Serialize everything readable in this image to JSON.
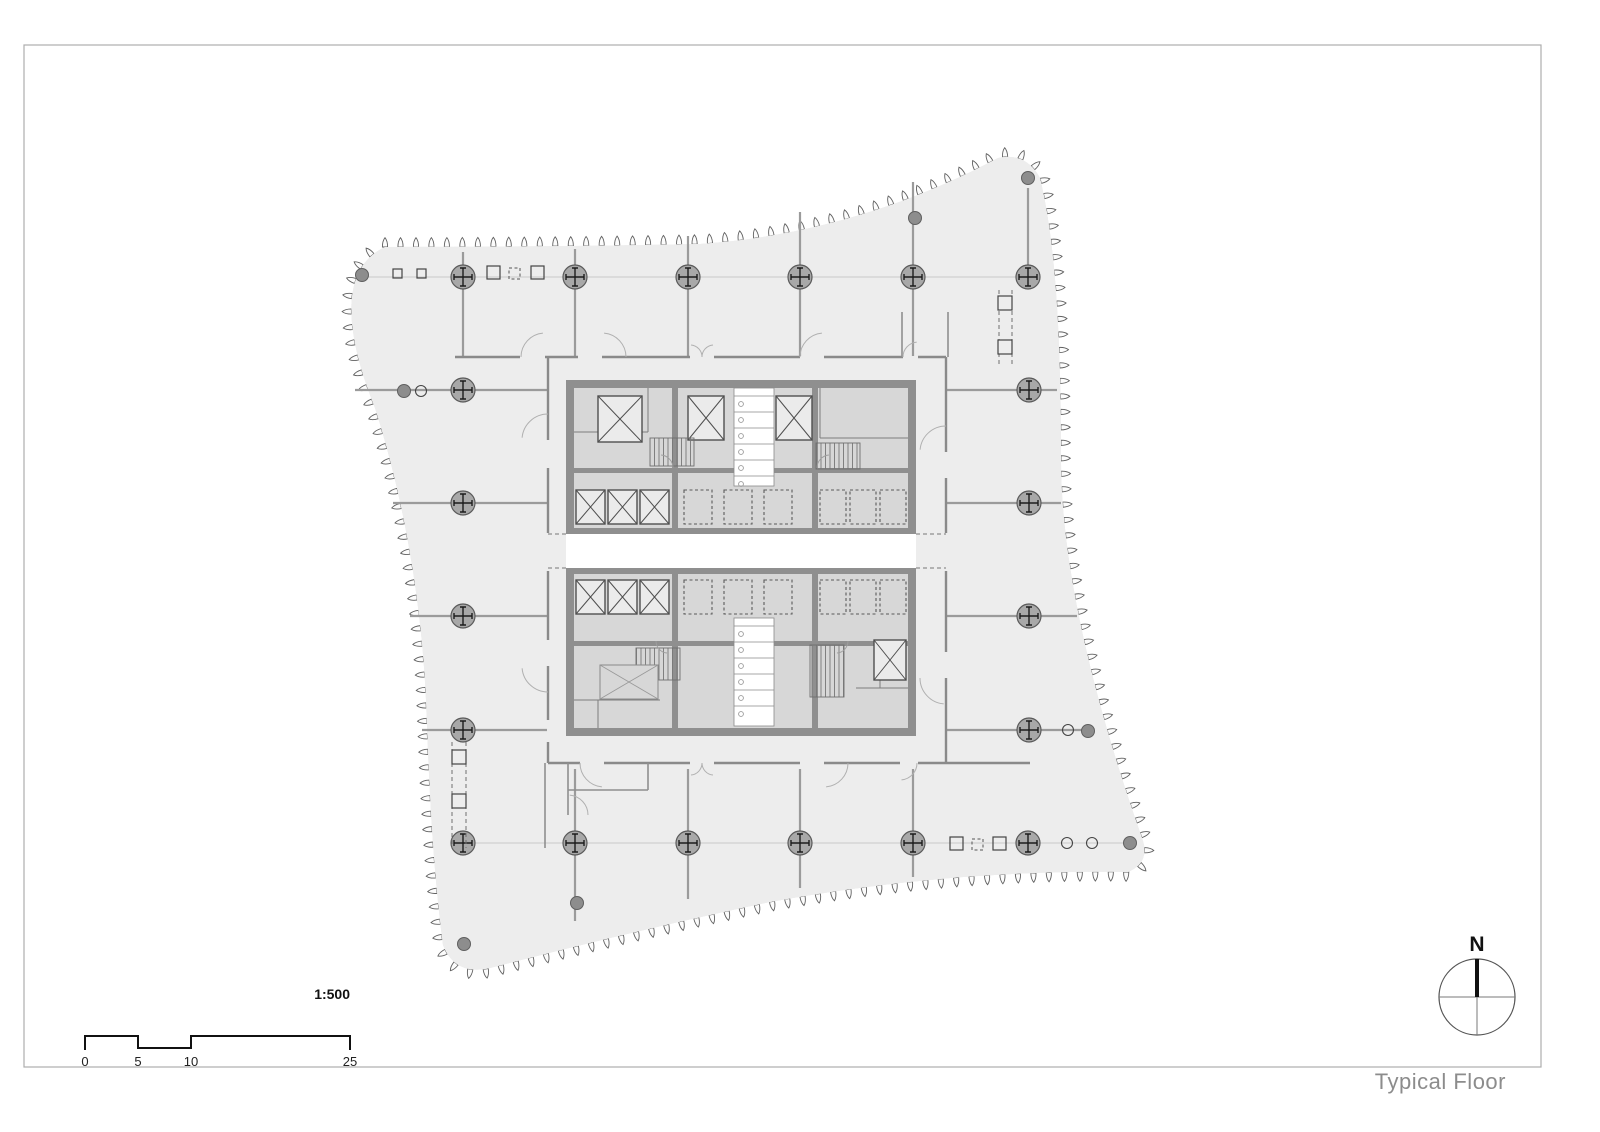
{
  "sheet": {
    "title": "Typical Floor"
  },
  "scale_bar": {
    "ratio": "1:500",
    "marks": [
      "0",
      "5",
      "10",
      "25"
    ]
  },
  "north_arrow": {
    "label": "N"
  },
  "colors": {
    "building_fill": "#ededed",
    "outline_stroke": "#6a6a6a",
    "core_wall": "#8f8f8f",
    "room_fill": "#d7d7d7",
    "column_fill": "#a8a8a8",
    "partition_line": "#9b9b9b",
    "title_text": "#8c8c8c"
  }
}
